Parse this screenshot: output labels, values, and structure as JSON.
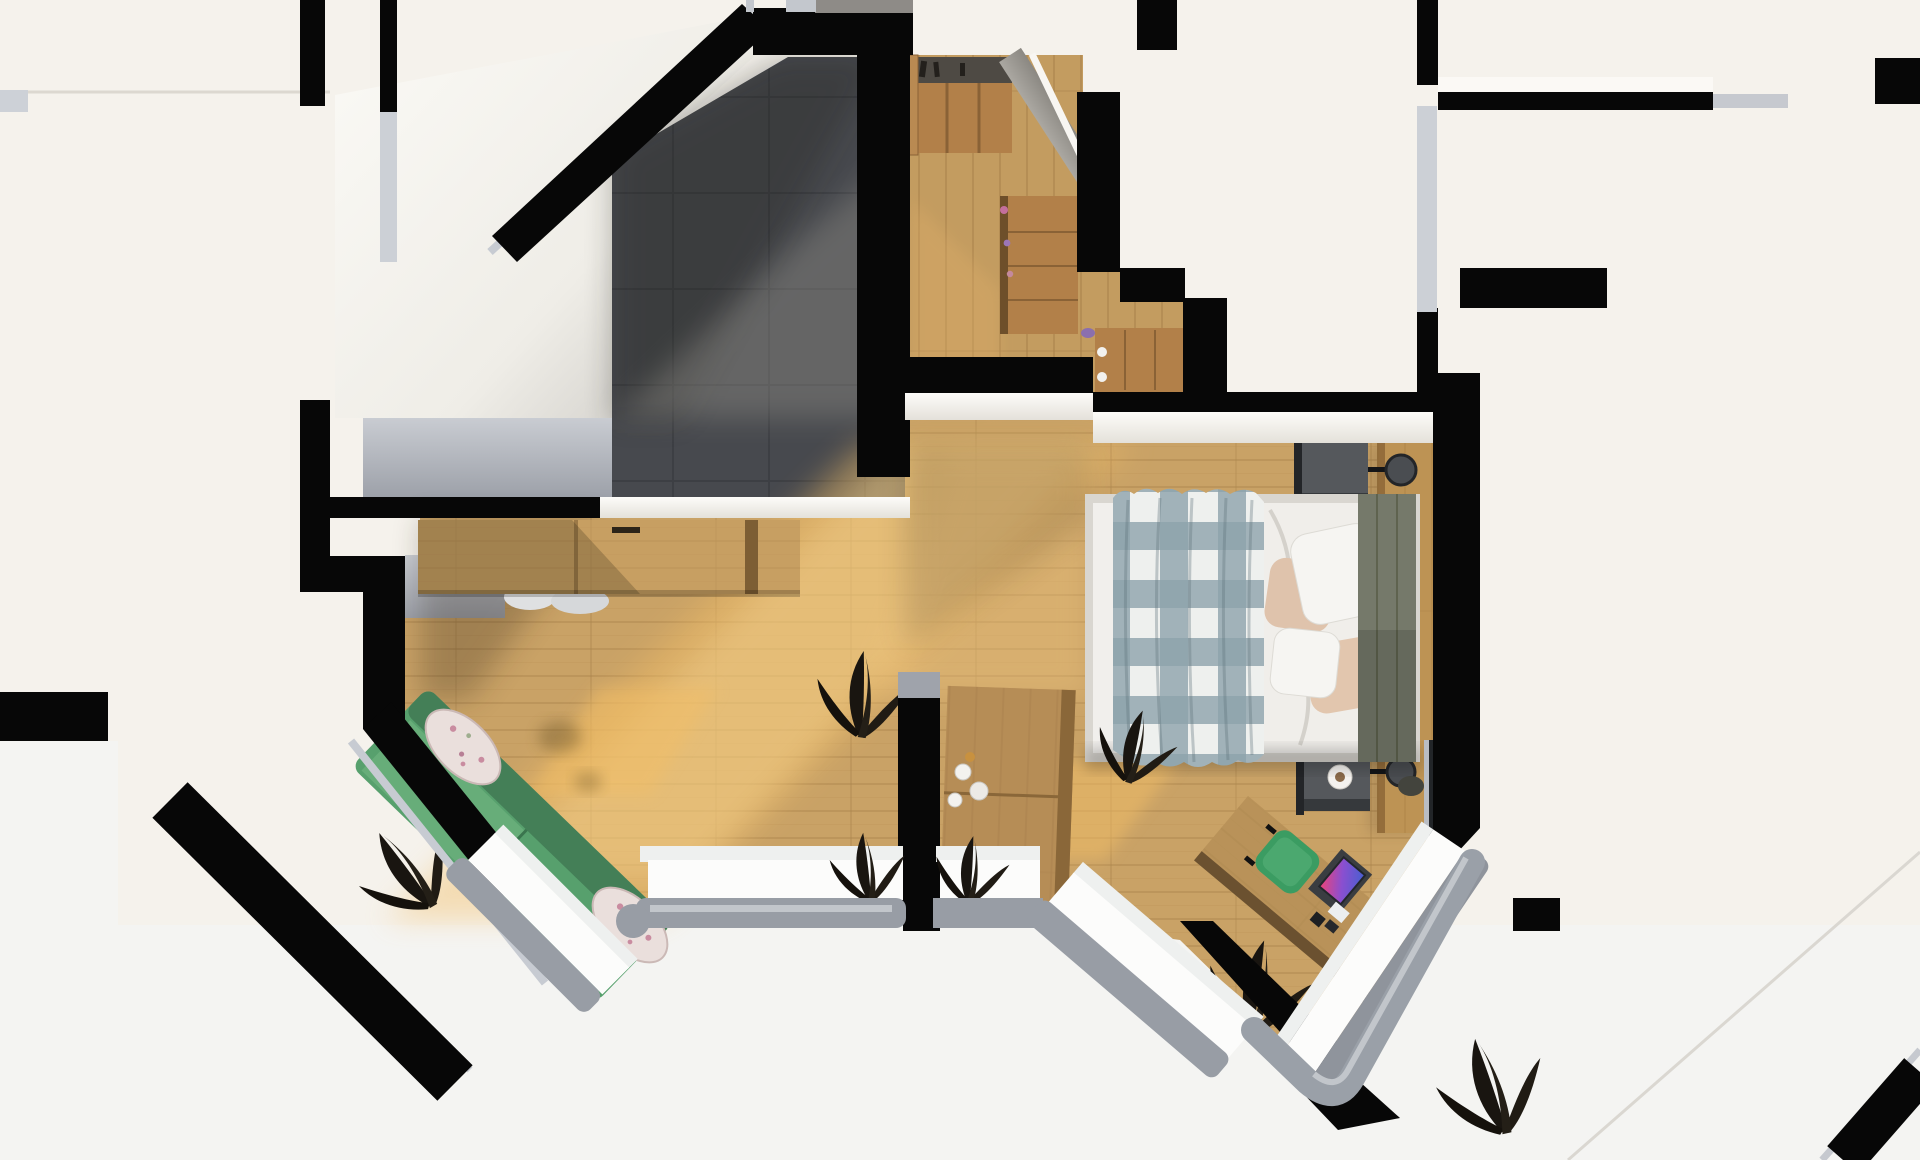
{
  "scene": {
    "label": "Top-down 3D render of an attic apartment floor plan",
    "render_style": "orthographic top view, afternoon sunlight from lower left",
    "palette": {
      "outside_cream": "#f5f2ec",
      "outside_ground": "#f4f4f2",
      "wall_black": "#070707",
      "wall_cap_silver": "#c7cbd2",
      "interior_white": "#f3f1ec",
      "sloped_ceiling_white": "#f7f5f0",
      "tile_floor": "#47494e",
      "wood_floor": "#c9a266",
      "wood_furniture": "#b28049",
      "sofa_green": "#57a06d",
      "chair_green": "#3b9c62",
      "plaid_blue_gray": "#8da2ab",
      "pillow_beige": "#dfc3ac",
      "headboard_olive": "#75796a",
      "nightstand_gray": "#55585c",
      "window_frame_gray": "#989da5",
      "glass_white": "#fcfcfb",
      "plant_dark": "#191510",
      "laptop_screen": [
        "#e8447c",
        "#8a4fd0",
        "#4a5fd0"
      ]
    }
  },
  "rooms": {
    "stair_room": {
      "label": "Tiled room with sloped roof walls",
      "floor": "dark gray tiles"
    },
    "dressing": {
      "label": "Dressing room with open wardrobe and two dressers",
      "floor": "wood planks"
    },
    "studio": {
      "label": "Studio room with wall desk, chairs and green sofa in bay nook",
      "floor": "wood planks"
    },
    "bedroom": {
      "label": "Bedroom with double bed, nightstands and corner desk in bay nook",
      "floor": "wood planks"
    },
    "empty_room": {
      "label": "Unfurnished room (top right)"
    },
    "neighbours": {
      "label": "Neighbouring units and roof edges (cropped at image borders)"
    }
  },
  "furniture": {
    "wall_desk": {
      "label": "Long wooden wall desk with two chairs"
    },
    "sofa": {
      "label": "Green sofa with two floral bolster cushions"
    },
    "bed": {
      "label": "Double bed with white duvet and checked plaid blanket"
    },
    "plaid": {
      "label": "Gray-white gingham blanket"
    },
    "pillows": {
      "label": "Two white and two beige pillows"
    },
    "headboard": {
      "label": "Olive upholstered headboard on wood accent wall"
    },
    "nightstand_top": {
      "label": "Dark nightstand with black wall lamp"
    },
    "nightstand_bottom": {
      "label": "Dark nightstand with coffee cup, vase and wall lamp"
    },
    "side_cabinet": {
      "label": "Small wooden cabinet with cups"
    },
    "corner_desk": {
      "label": "Angled desk with laptop, boxes and green chair"
    },
    "laptop": {
      "label": "Open laptop with colorful screen artwork"
    },
    "wardrobe": {
      "label": "Open wardrobe with clothes rail"
    },
    "dresser_right": {
      "label": "Wooden dresser with pink accessories"
    },
    "dresser_bottom": {
      "label": "Low wooden dresser with white knobs"
    },
    "tv_panel": {
      "label": "Dark TV panel on bedroom wall"
    },
    "plants": {
      "label": "Dark green floor and window-sill plants"
    }
  },
  "windows": {
    "left_bay": {
      "label": "Left bay window nook with angled and straight glazing"
    },
    "right_bay": {
      "label": "Right bay window nook with rounded gray frame"
    }
  }
}
